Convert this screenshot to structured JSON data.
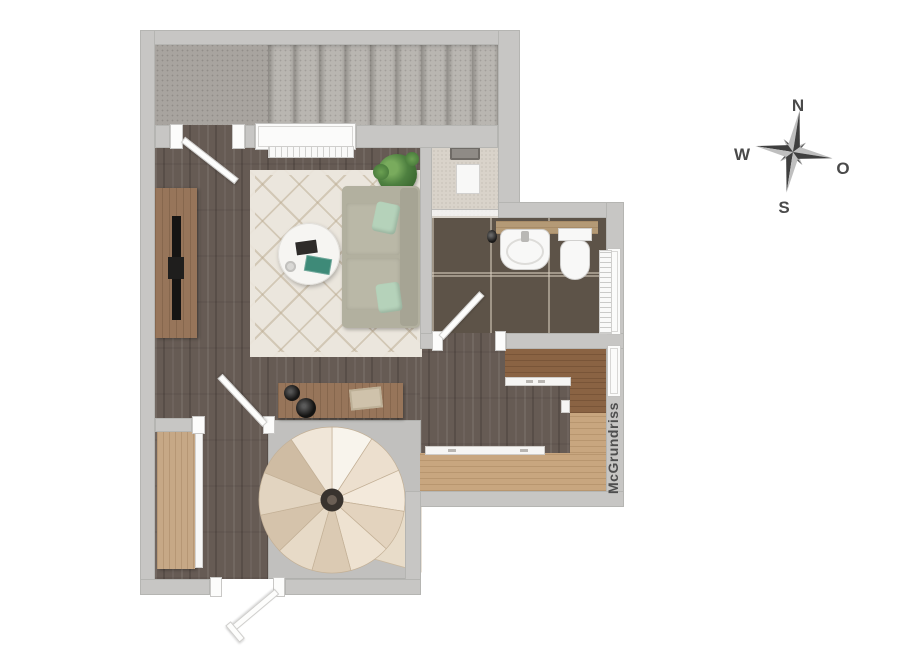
{
  "plan": {
    "type": "apartment-floor-plan-top-view",
    "watermark": "McGrundriss",
    "compass": {
      "north": "N",
      "west": "W",
      "east": "O",
      "south": "S"
    },
    "rooms": {
      "stair_hall": "staircase landing with 9 steps",
      "living_room": "living room with sofa, rug, round table, tv sideboard",
      "shower": "shower niche",
      "bathroom": "bathroom with basin, toilet, radiator",
      "kitchen": "kitchen nook with u-shaped counters",
      "lower_hall": "hall with wardrobe and spiral staircase"
    },
    "colors": {
      "wall": "#c7c6c4",
      "floor_dark_wood": "#665b54",
      "bath_tile": "#5d5348",
      "concrete": "#b2afaa",
      "counter_light_oak": "#c8a67f",
      "counter_walnut": "#8a6343",
      "rug": "#ebe6dd",
      "sofa": "#b2b09f",
      "pillow_mint": "#b5d2ba",
      "spiral_step_cream": "#ecdfce",
      "compass_dark": "#474747",
      "compass_light": "#bfbfbf",
      "watermark_text": "#4e4e4e"
    }
  }
}
